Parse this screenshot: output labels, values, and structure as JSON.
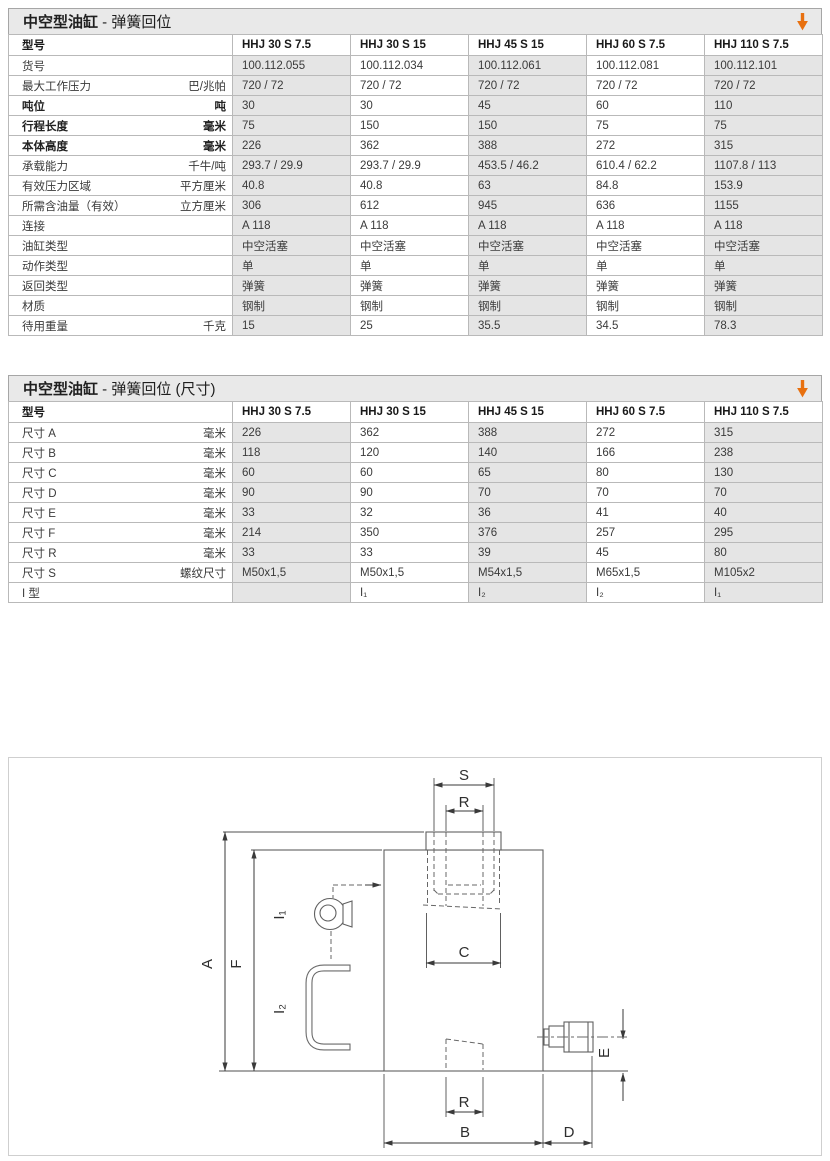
{
  "colors": {
    "accent_orange": "#e8700f",
    "cell_gray": "#e5e5e5",
    "title_gray": "#e9e9e9",
    "border_gray": "#b9b9b9"
  },
  "tables": [
    {
      "title_main": "中空型油缸",
      "title_sub": " - 弹簧回位",
      "header_label": "型号",
      "models": [
        "HHJ 30 S 7.5",
        "HHJ 30 S 15",
        "HHJ 45 S 15",
        "HHJ 60 S 7.5",
        "HHJ 110 S 7.5"
      ],
      "rows": [
        {
          "label": "货号",
          "unit": "",
          "bold": false,
          "values": [
            "100.112.055",
            "100.112.034",
            "100.112.061",
            "100.112.081",
            "100.112.101"
          ]
        },
        {
          "label": "最大工作压力",
          "unit": "巴/兆帕",
          "bold": false,
          "values": [
            "720 / 72",
            "720 / 72",
            "720 / 72",
            "720 / 72",
            "720 / 72"
          ]
        },
        {
          "label": "吨位",
          "unit": "吨",
          "bold": true,
          "values": [
            "30",
            "30",
            "45",
            "60",
            "110"
          ]
        },
        {
          "label": "行程长度",
          "unit": "毫米",
          "bold": true,
          "values": [
            "75",
            "150",
            "150",
            "75",
            "75"
          ]
        },
        {
          "label": "本体高度",
          "unit": "毫米",
          "bold": true,
          "values": [
            "226",
            "362",
            "388",
            "272",
            "315"
          ]
        },
        {
          "label": "承载能力",
          "unit": "千牛/吨",
          "bold": false,
          "values": [
            "293.7 / 29.9",
            "293.7 / 29.9",
            "453.5 / 46.2",
            "610.4 / 62.2",
            "1107.8 / 113"
          ]
        },
        {
          "label": "有效压力区域",
          "unit": "平方厘米",
          "bold": false,
          "values": [
            "40.8",
            "40.8",
            "63",
            "84.8",
            "153.9"
          ]
        },
        {
          "label": "所需含油量（有效）",
          "unit": "立方厘米",
          "bold": false,
          "values": [
            "306",
            "612",
            "945",
            "636",
            "1155"
          ]
        },
        {
          "label": "连接",
          "unit": "",
          "bold": false,
          "values": [
            "A 118",
            "A 118",
            "A 118",
            "A 118",
            "A 118"
          ]
        },
        {
          "label": "油缸类型",
          "unit": "",
          "bold": false,
          "values": [
            "中空活塞",
            "中空活塞",
            "中空活塞",
            "中空活塞",
            "中空活塞"
          ]
        },
        {
          "label": "动作类型",
          "unit": "",
          "bold": false,
          "values": [
            "单",
            "单",
            "单",
            "单",
            "单"
          ]
        },
        {
          "label": "返回类型",
          "unit": "",
          "bold": false,
          "values": [
            "弹簧",
            "弹簧",
            "弹簧",
            "弹簧",
            "弹簧"
          ]
        },
        {
          "label": "材质",
          "unit": "",
          "bold": false,
          "values": [
            "钢制",
            "钢制",
            "钢制",
            "钢制",
            "钢制"
          ]
        },
        {
          "label": "待用重量",
          "unit": "千克",
          "bold": false,
          "values": [
            "15",
            "25",
            "35.5",
            "34.5",
            "78.3"
          ]
        }
      ]
    },
    {
      "title_main": "中空型油缸",
      "title_sub": " - 弹簧回位 (尺寸)",
      "header_label": "型号",
      "models": [
        "HHJ 30 S 7.5",
        "HHJ 30 S 15",
        "HHJ 45 S 15",
        "HHJ 60 S 7.5",
        "HHJ 110 S 7.5"
      ],
      "rows": [
        {
          "label": "尺寸 A",
          "unit": "毫米",
          "bold": false,
          "values": [
            "226",
            "362",
            "388",
            "272",
            "315"
          ]
        },
        {
          "label": "尺寸 B",
          "unit": "毫米",
          "bold": false,
          "values": [
            "118",
            "120",
            "140",
            "166",
            "238"
          ]
        },
        {
          "label": "尺寸 C",
          "unit": "毫米",
          "bold": false,
          "values": [
            "60",
            "60",
            "65",
            "80",
            "130"
          ]
        },
        {
          "label": "尺寸 D",
          "unit": "毫米",
          "bold": false,
          "values": [
            "90",
            "90",
            "70",
            "70",
            "70"
          ]
        },
        {
          "label": "尺寸 E",
          "unit": "毫米",
          "bold": false,
          "values": [
            "33",
            "32",
            "36",
            "41",
            "40"
          ]
        },
        {
          "label": "尺寸 F",
          "unit": "毫米",
          "bold": false,
          "values": [
            "214",
            "350",
            "376",
            "257",
            "295"
          ]
        },
        {
          "label": "尺寸 R",
          "unit": "毫米",
          "bold": false,
          "values": [
            "33",
            "33",
            "39",
            "45",
            "80"
          ]
        },
        {
          "label": "尺寸 S",
          "unit": "螺纹尺寸",
          "bold": false,
          "values": [
            "M50x1,5",
            "M50x1,5",
            "M54x1,5",
            "M65x1,5",
            "M105x2"
          ]
        },
        {
          "label": "I 型",
          "unit": "",
          "bold": false,
          "values": [
            "",
            "I₁",
            "I₂",
            "I₂",
            "I₁"
          ]
        }
      ]
    }
  ],
  "diagram": {
    "labels": {
      "S": "S",
      "R_top": "R",
      "C": "C",
      "A": "A",
      "F": "F",
      "I1": "I₁",
      "I2": "I₂",
      "E": "E",
      "R_bottom": "R",
      "B": "B",
      "D": "D"
    }
  }
}
